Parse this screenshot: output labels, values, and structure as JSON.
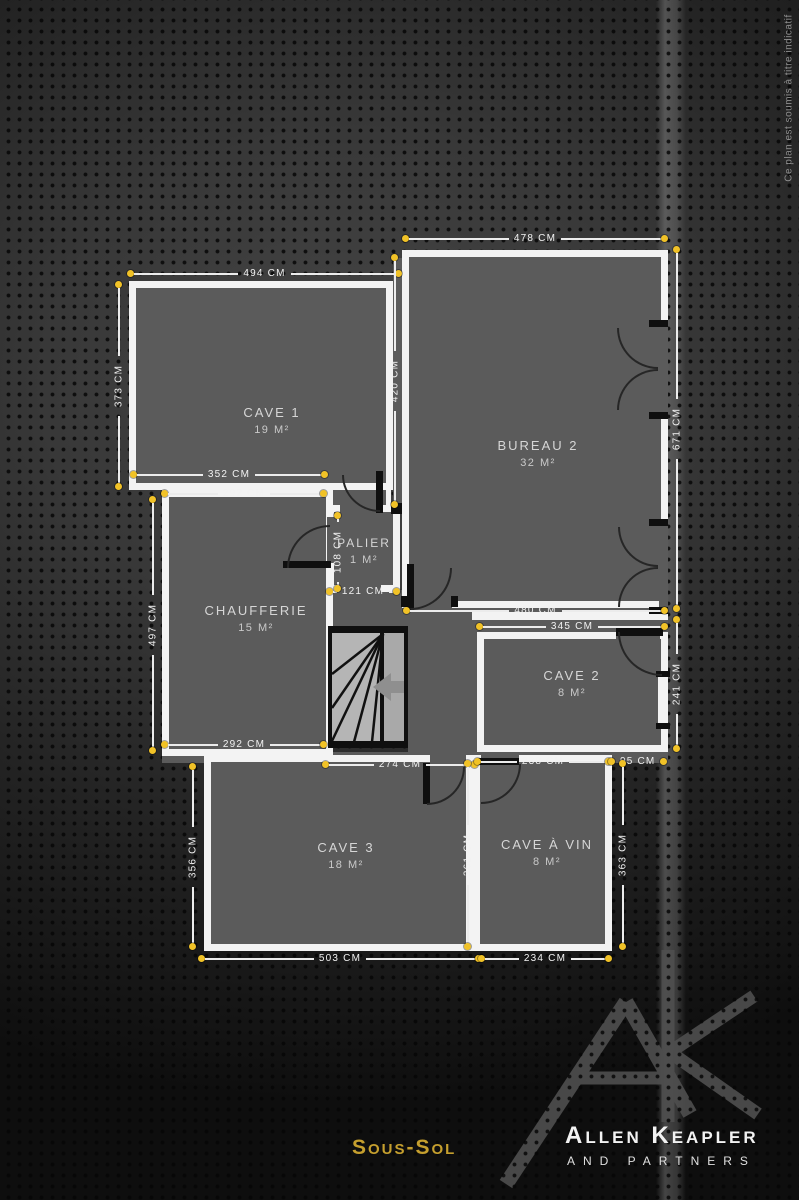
{
  "plan": {
    "rooms": [
      {
        "name": "Cave 1",
        "area": "19 m²"
      },
      {
        "name": "Bureau 2",
        "area": "32 m²"
      },
      {
        "name": "Palier",
        "area": "1 m²"
      },
      {
        "name": "Chaufferie",
        "area": "15 m²"
      },
      {
        "name": "Cave 2",
        "area": "8 m²"
      },
      {
        "name": "Cave 3",
        "area": "18 m²"
      },
      {
        "name": "Cave à vin",
        "area": "8 m²"
      }
    ],
    "dimensions": [
      {
        "label": "478 cm"
      },
      {
        "label": "494 cm"
      },
      {
        "label": "352 cm"
      },
      {
        "label": "292 cm"
      },
      {
        "label": "121 cm"
      },
      {
        "label": "480 cm"
      },
      {
        "label": "345 cm"
      },
      {
        "label": "292 cm"
      },
      {
        "label": "274 cm"
      },
      {
        "label": "238 cm"
      },
      {
        "label": "95 cm"
      },
      {
        "label": "503 cm"
      },
      {
        "label": "234 cm"
      },
      {
        "label": "373 cm"
      },
      {
        "label": "420 cm"
      },
      {
        "label": "671 cm"
      },
      {
        "label": "108 cm"
      },
      {
        "label": "497 cm"
      },
      {
        "label": "241 cm"
      },
      {
        "label": "356 cm"
      },
      {
        "label": "361 cm"
      },
      {
        "label": "363 cm"
      }
    ]
  },
  "footer": {
    "floor_label": "Sous-Sol",
    "brand_name": "Allen Keapler",
    "brand_subtitle": "and partners",
    "monogram": "Ak"
  },
  "side_note": "Ce plan est soumis à titre indicatif",
  "colors": {
    "accent_dot": "#f1c227",
    "title_gold": "#c59f2e",
    "wall": "#f3f3f3",
    "room_fill": "#5b5b5b"
  }
}
